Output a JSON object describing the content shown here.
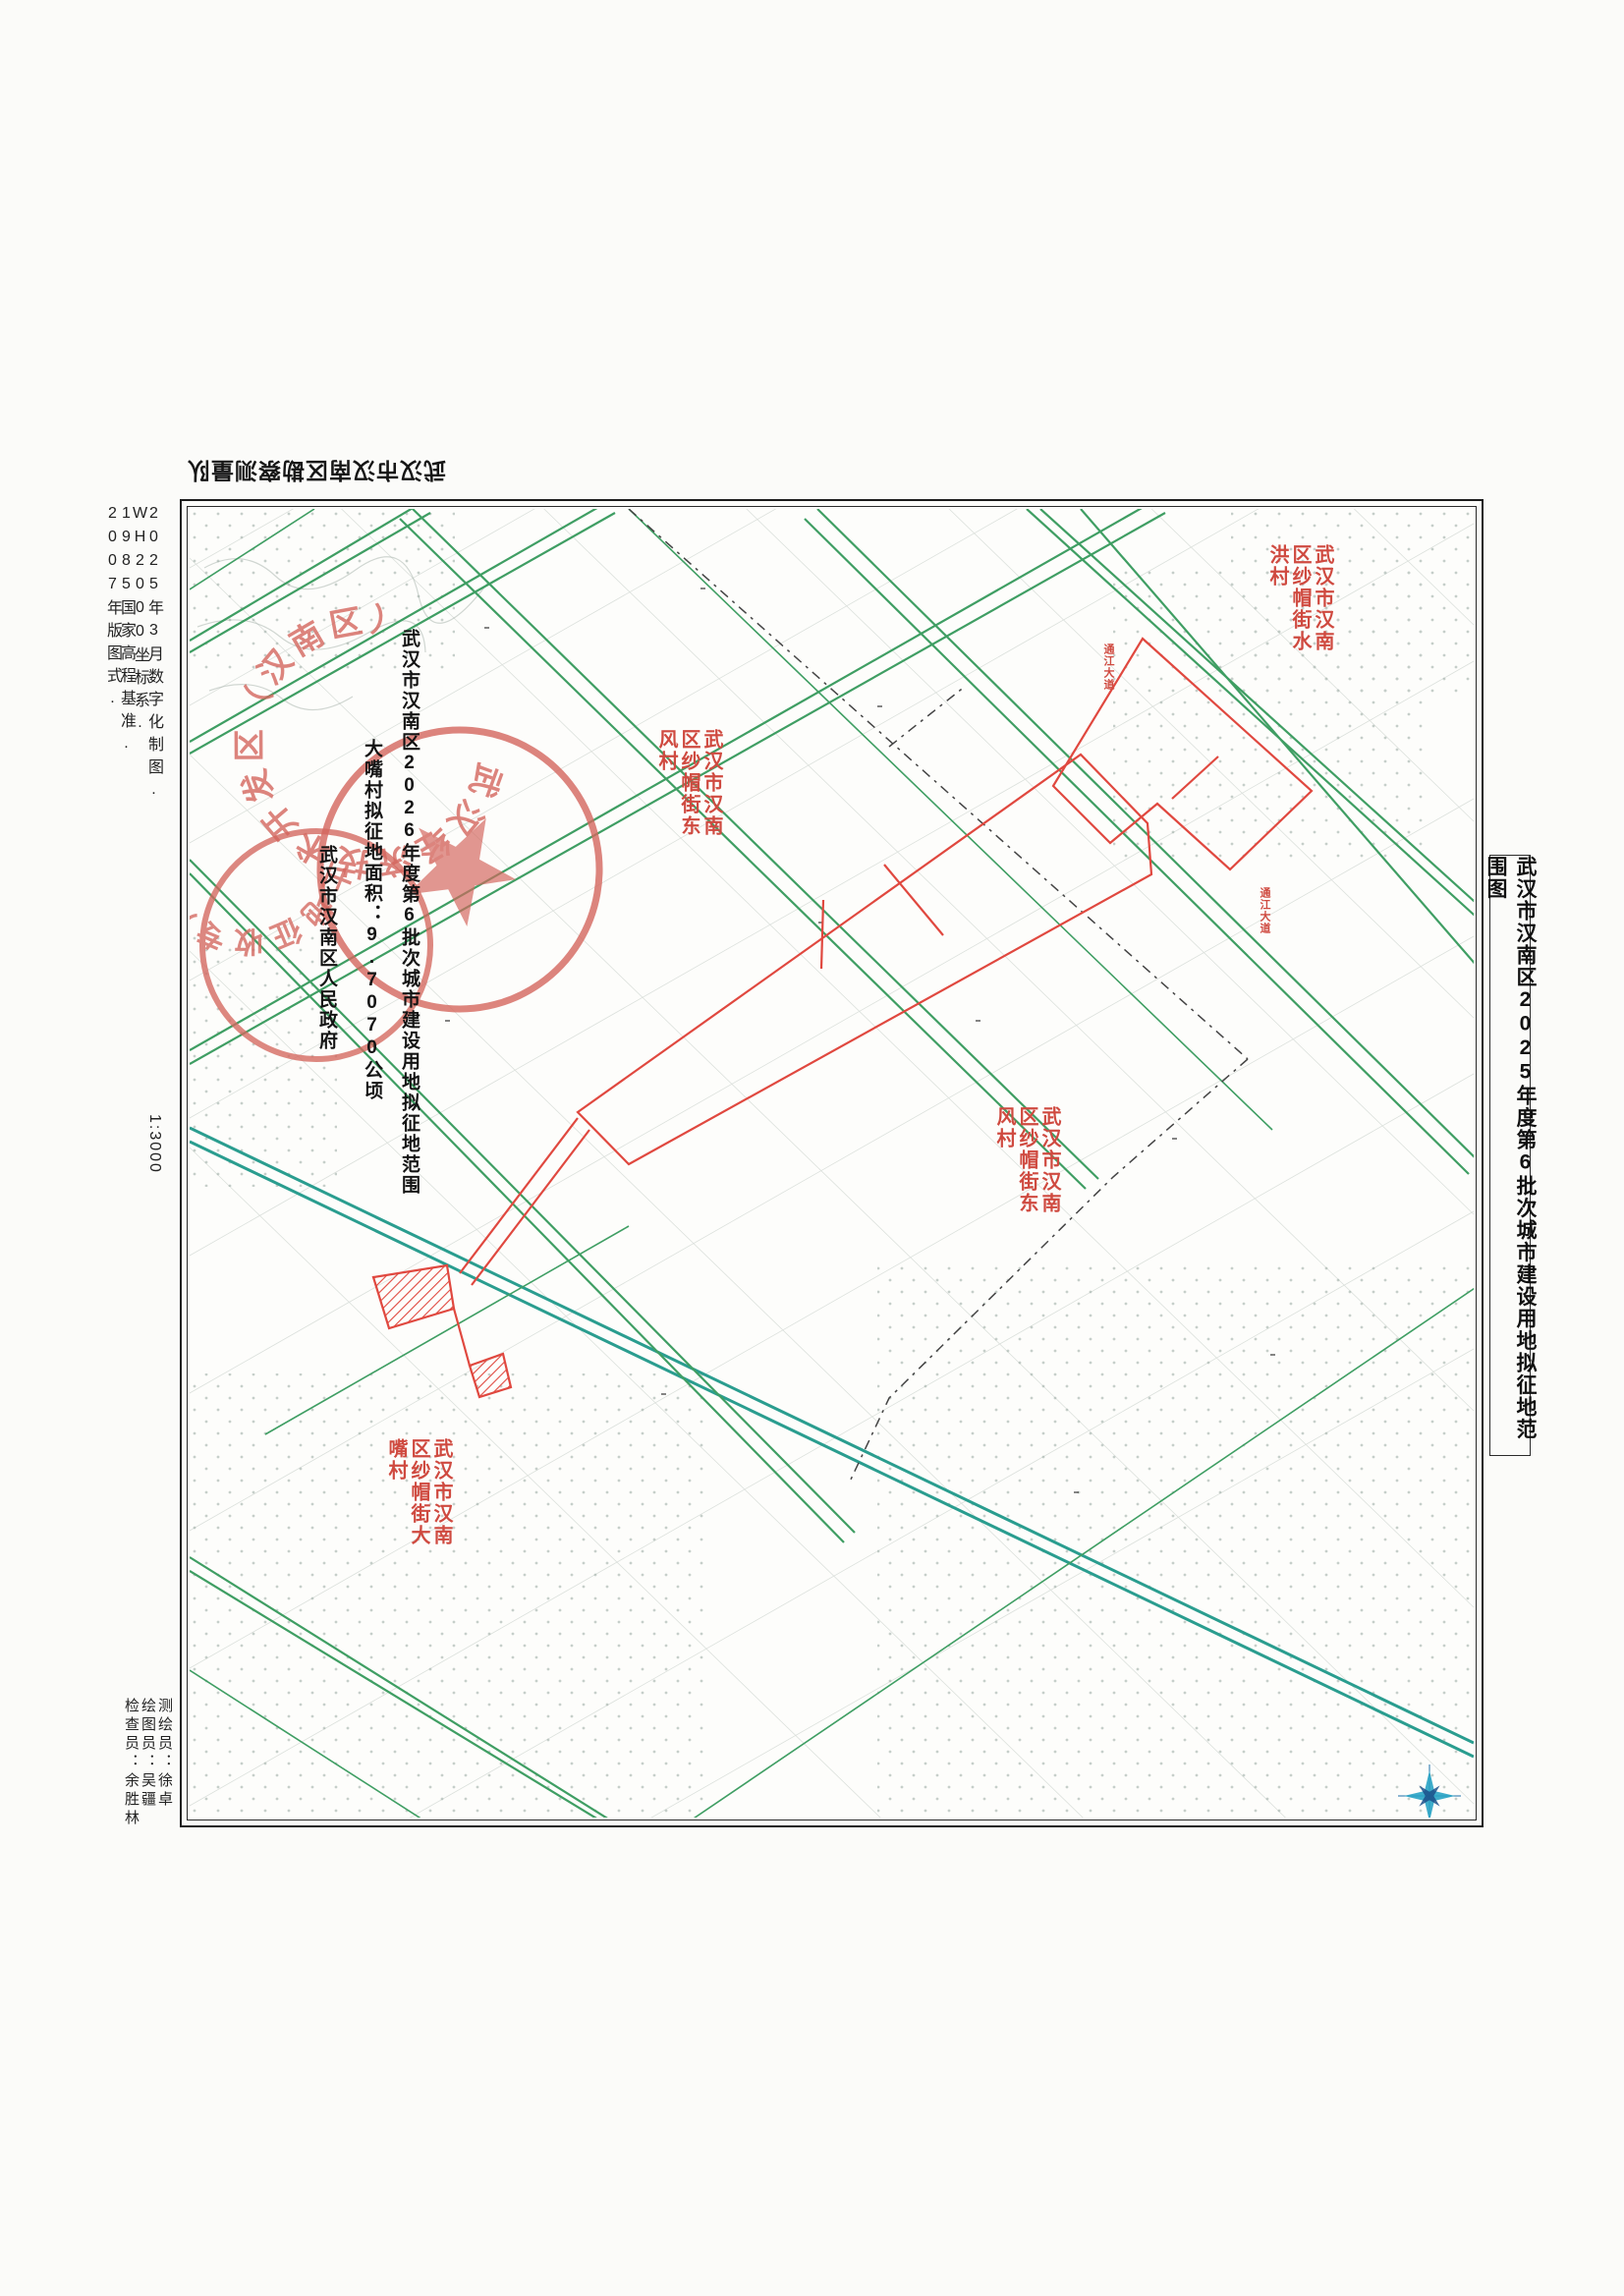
{
  "document": {
    "sheet_title": "武汉市汉南区2025年度第6批次城市建设用地拟征地范围图",
    "agency_flipped": "武汉市汉南区勘察测量队",
    "scale_label": "1:3000",
    "margin_notes": [
      "2025年3月数字化制图.",
      "WH2000坐标系.",
      "1985国家高程基准.",
      "2007年版图式."
    ],
    "credits": [
      "测绘员：徐卓",
      "绘图员：吴疆",
      "检查员：余胜林"
    ]
  },
  "map": {
    "annotation_columns": [
      {
        "text": "武汉市汉南区2026年度第6批次城市建设用地拟征地范围"
      },
      {
        "text": "大嘴村拟征地面积：9.7070公顷"
      },
      {
        "text": "武汉市汉南区人民政府"
      }
    ],
    "village_labels": [
      {
        "text": "武汉市汉南区纱帽街水洪村"
      },
      {
        "text": "武汉市汉南区纱帽街东风村"
      },
      {
        "text": "武汉市汉南区纱帽街东风村"
      },
      {
        "text": "武汉市汉南区纱帽街大嘴村"
      }
    ],
    "road_labels": [
      {
        "text": "通江大道"
      },
      {
        "text": "通江大道"
      }
    ],
    "stamps": {
      "outer_ring_text": "武汉经济技术开发区（汉南区）",
      "inner_ring_text": "土地征收专用章"
    },
    "legend_colors": {
      "road_green": "#3f9e63",
      "major_road_teal": "#2a9d8f",
      "parcel_outline_red": "#e0483f",
      "stamp_red": "#d4665e",
      "field_dot_gray": "#8fa098"
    }
  }
}
